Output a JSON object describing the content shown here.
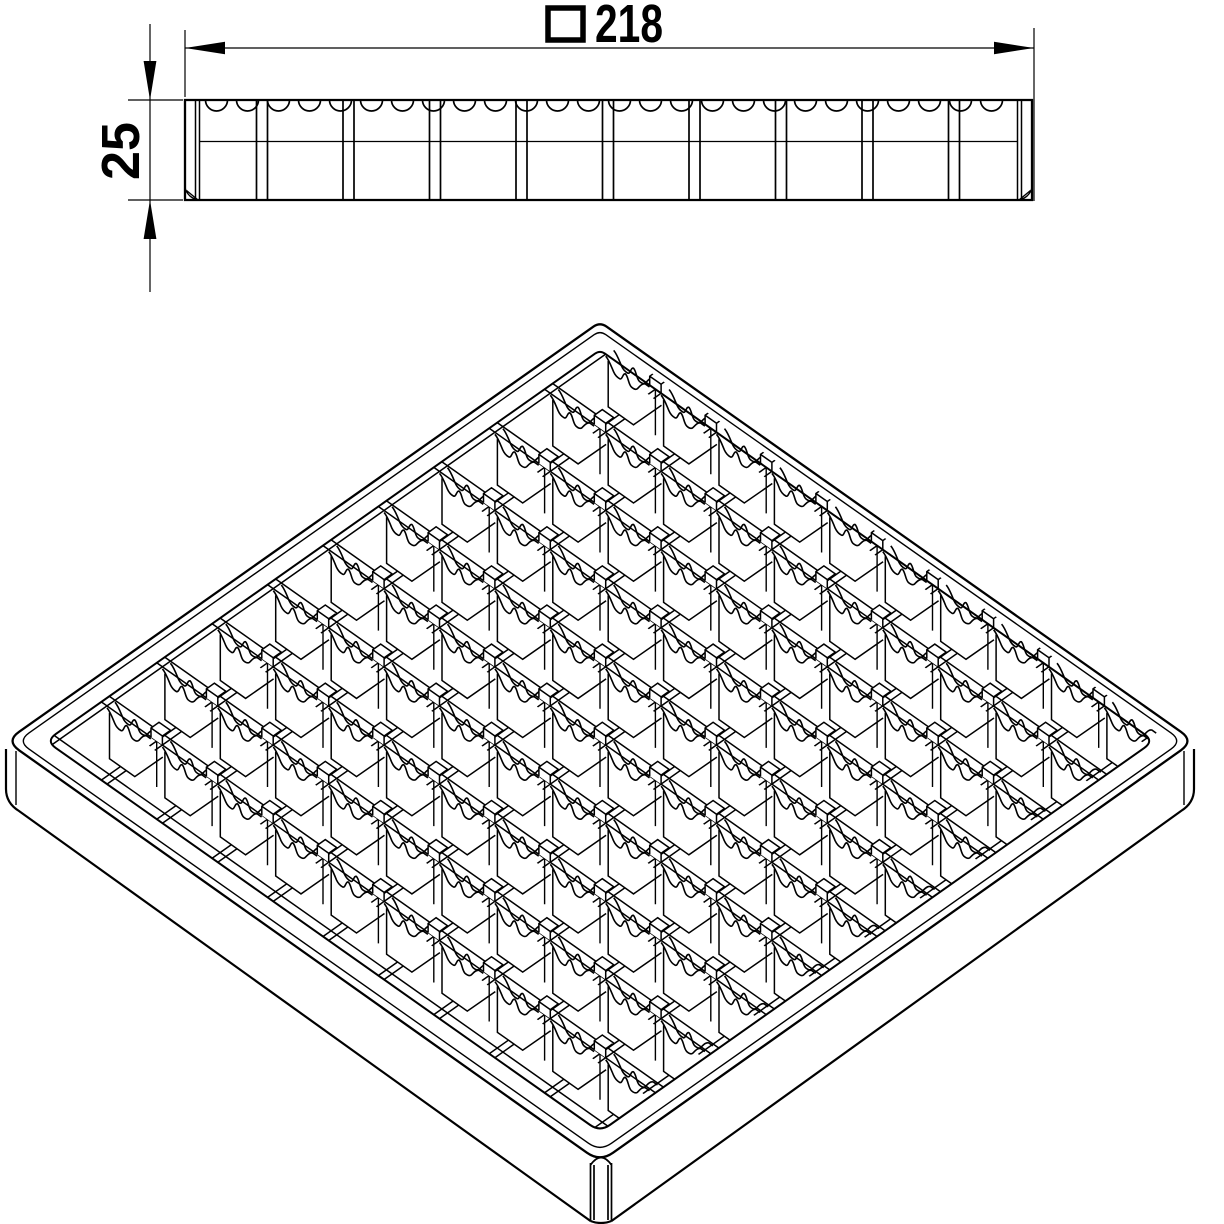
{
  "colors": {
    "ink": "#000000",
    "paper": "#ffffff"
  },
  "dimensions": {
    "width": {
      "symbol": "□",
      "value": "218"
    },
    "height": {
      "value": "25"
    }
  },
  "part": {
    "grid_cells_per_side": 10,
    "views_shown": 2
  }
}
